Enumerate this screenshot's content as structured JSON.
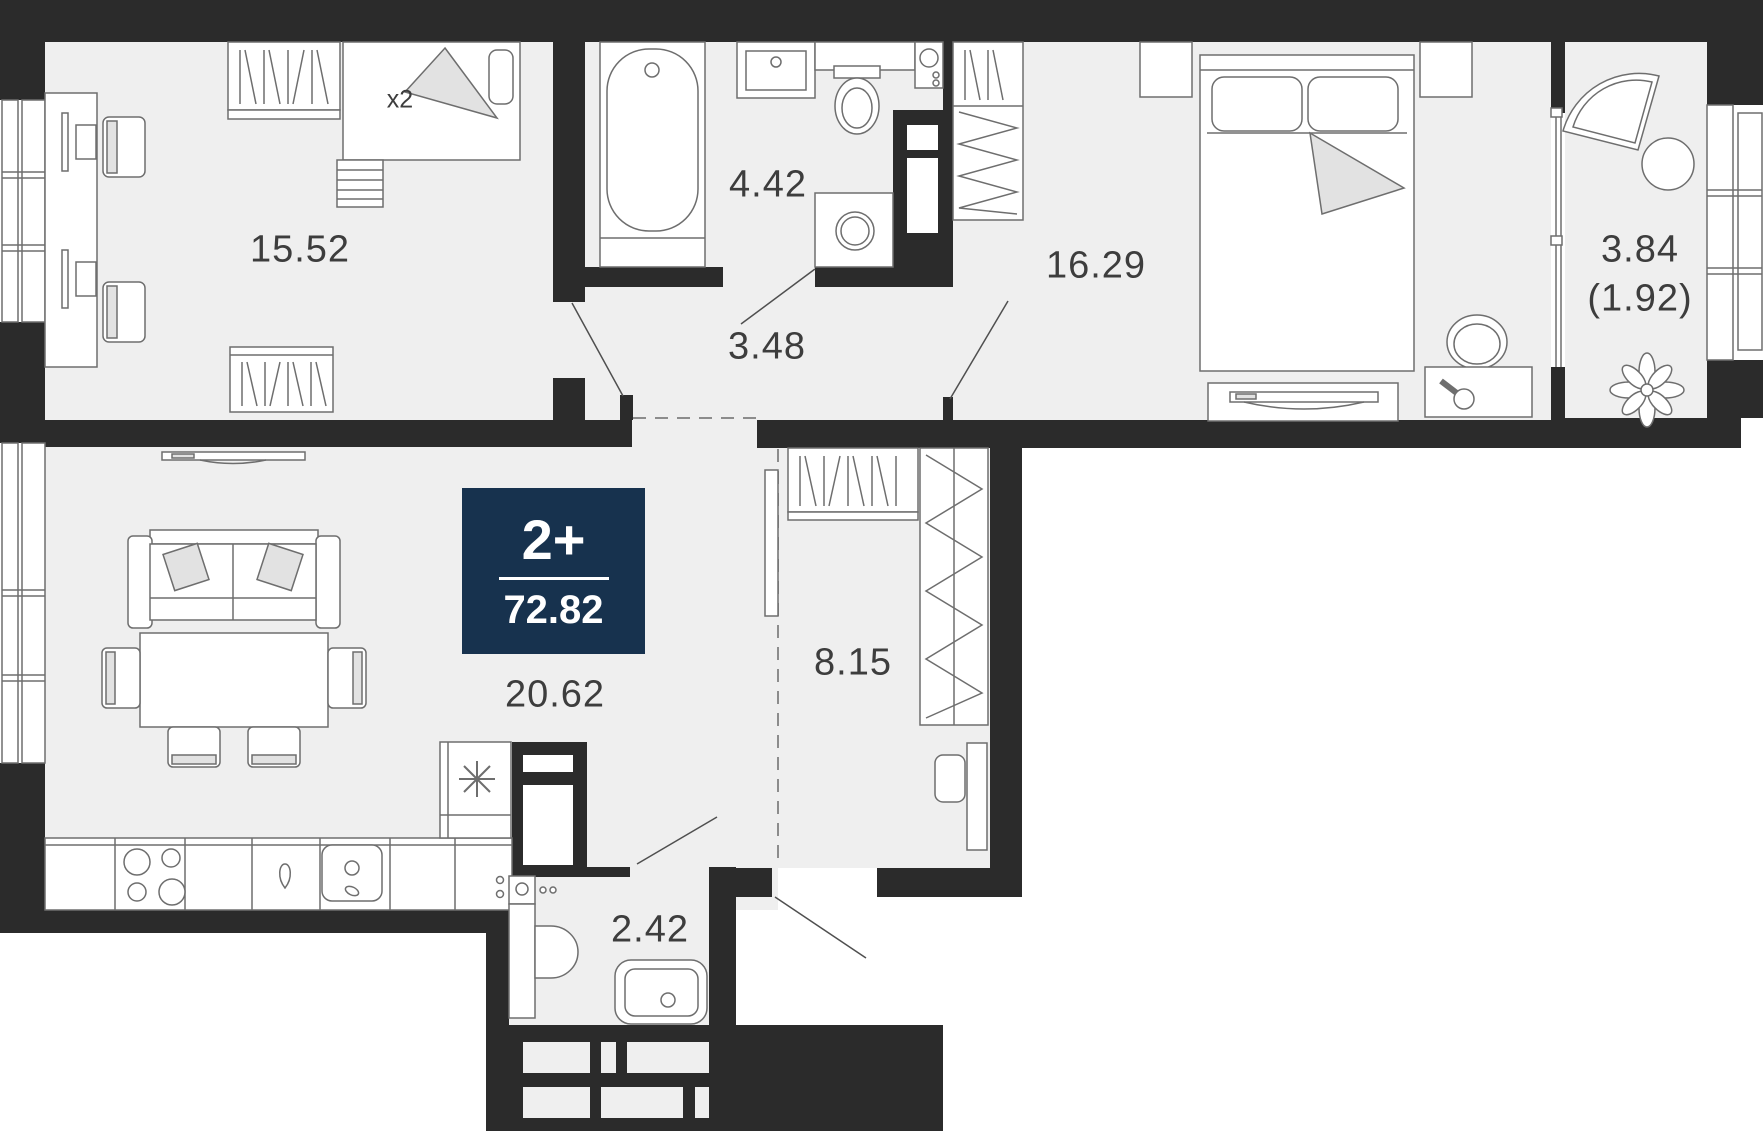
{
  "plan": {
    "badge": {
      "rooms": "2+",
      "total_area": "72.82",
      "bg_color": "#17324e"
    },
    "rooms": [
      {
        "id": "children-room",
        "area": "15.52",
        "note": "x2"
      },
      {
        "id": "bathroom",
        "area": "4.42"
      },
      {
        "id": "hallway",
        "area": "3.48"
      },
      {
        "id": "bedroom",
        "area": "16.29"
      },
      {
        "id": "balcony",
        "area": "3.84",
        "area_reduced": "(1.92)"
      },
      {
        "id": "living-kitchen",
        "area": "20.62"
      },
      {
        "id": "corridor",
        "area": "8.15"
      },
      {
        "id": "wc",
        "area": "2.42"
      }
    ],
    "colors": {
      "wall": "#2b2b2b",
      "floor": "#efefef",
      "outline": "#6e6e6e",
      "label": "#3d3d3d",
      "badge": "#17324e"
    }
  }
}
